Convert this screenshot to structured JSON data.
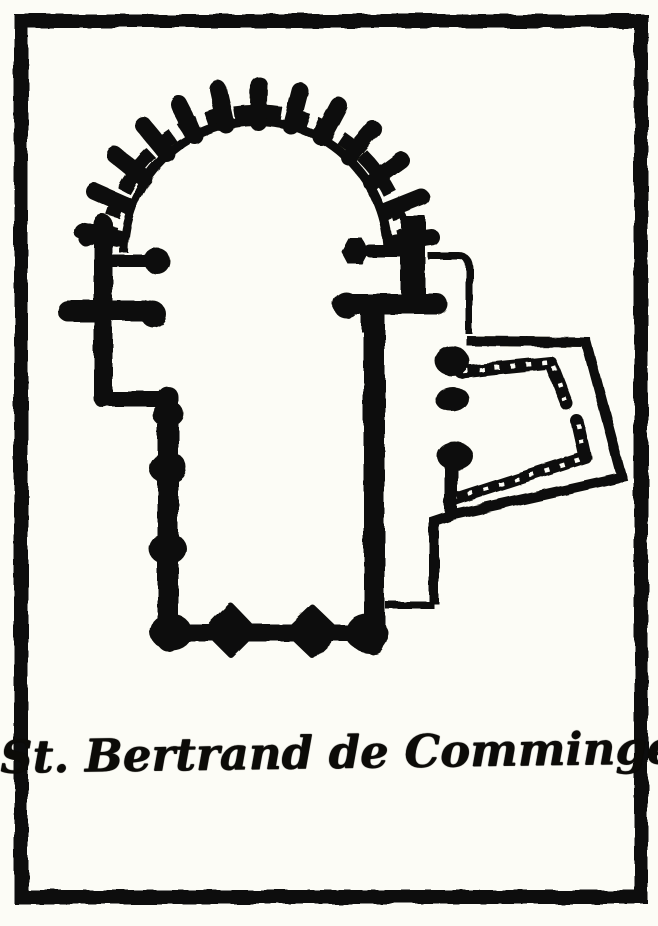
{
  "figure": {
    "caption": "St. Bertrand de Comminges"
  },
  "colors": {
    "ink": "#0c0b08",
    "paper": "#fcfcf6"
  },
  "plan": {
    "parts": [
      "outer-frame",
      "apse-chevet-buttresses",
      "apse-inner-arc",
      "choir-left-wall",
      "choir-right-wall",
      "left-chapel-piers",
      "right-chapel-piers",
      "nave-left-wall",
      "nave-right-wall",
      "west-front-wall",
      "west-front-buttress-piers",
      "aisle-thin-wall",
      "cloister-outer-wall",
      "cloister-arcade",
      "cloister-piers",
      "figure-caption"
    ]
  }
}
